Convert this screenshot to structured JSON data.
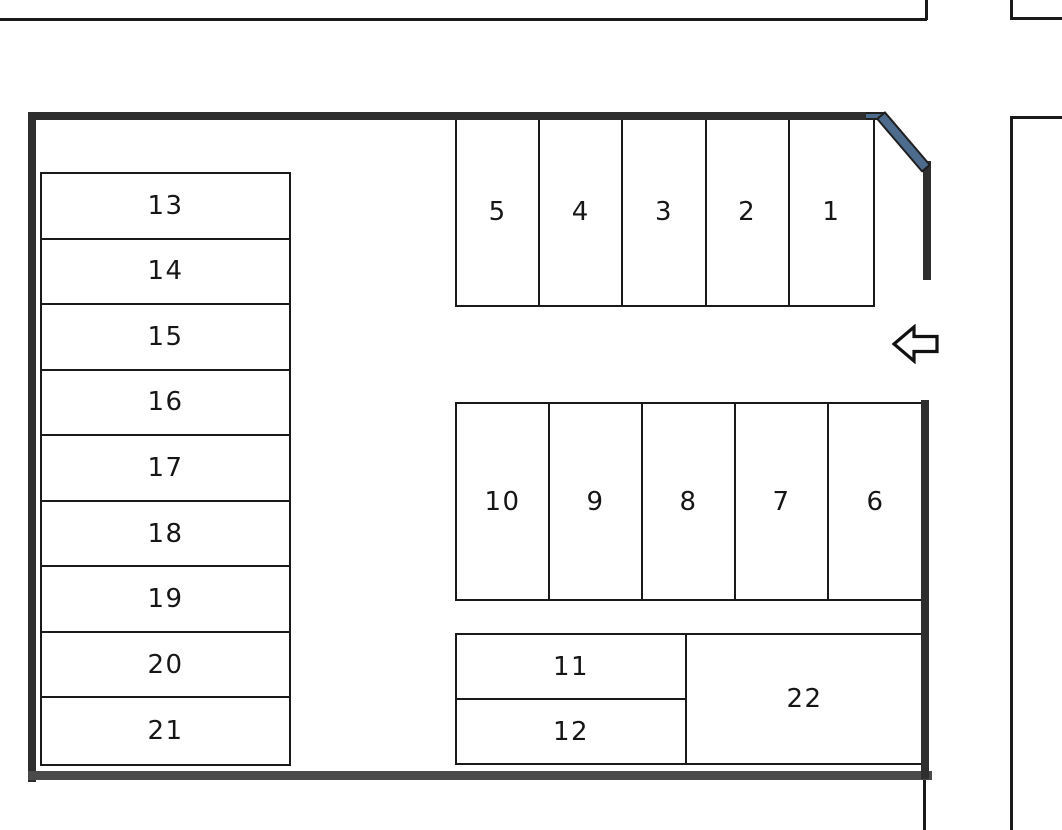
{
  "diagram_title": "parking-lot-layout",
  "spaces": {
    "top": [
      "5",
      "4",
      "3",
      "2",
      "1"
    ],
    "middle": [
      "10",
      "9",
      "8",
      "7",
      "6"
    ],
    "left_column": [
      "13",
      "14",
      "15",
      "16",
      "17",
      "18",
      "19",
      "20",
      "21"
    ],
    "bottom": [
      "11",
      "12",
      "22"
    ]
  },
  "entrance": {
    "arrow_direction": "left",
    "arrow_icon": "left-block-arrow"
  },
  "colors": {
    "background": "#ffffff",
    "thin_line": "#1a1a1a",
    "wall": "#2e2e2e",
    "wall_bottom": "#4a4a4a",
    "gate_accent": "#4d6b8c"
  }
}
